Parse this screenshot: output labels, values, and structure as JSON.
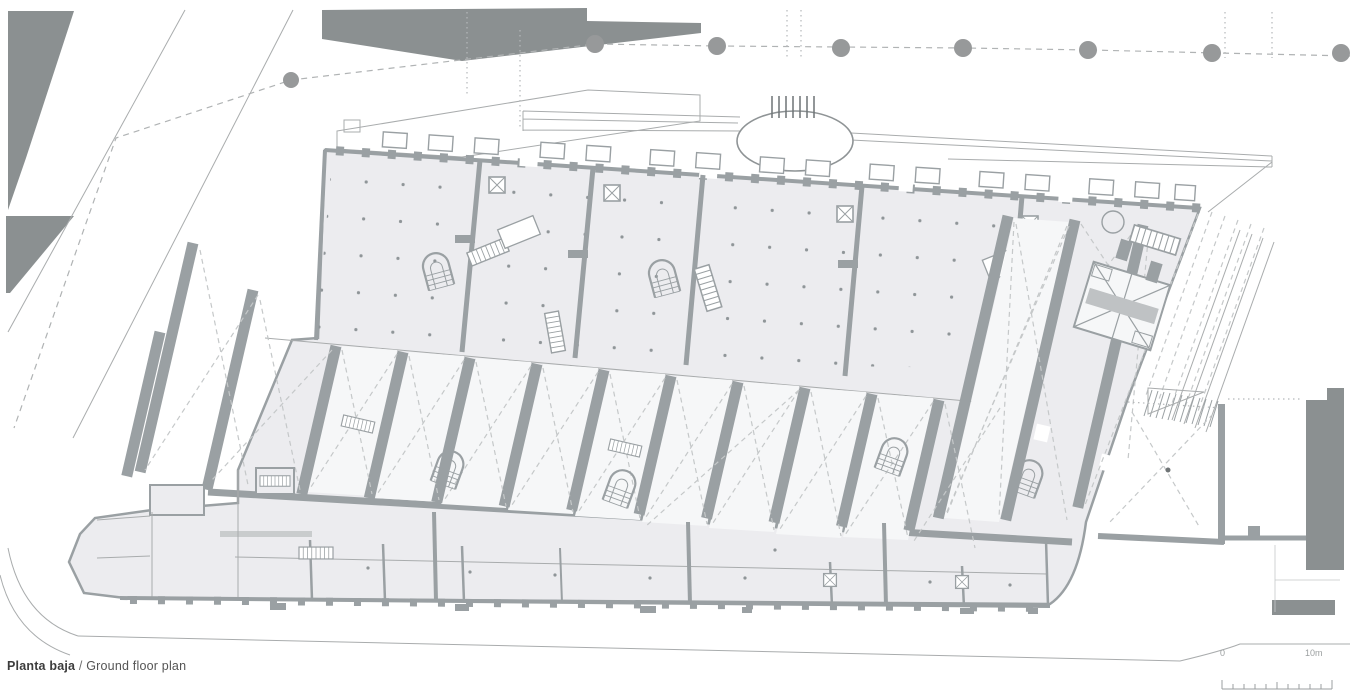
{
  "caption": {
    "label_es": "Planta baja",
    "separator": " / ",
    "label_en": "Ground floor plan"
  },
  "scale_bar": {
    "zero_label": "0",
    "end_label": "10m",
    "divisions": 10
  },
  "palette": {
    "context-dark": "#8b9091",
    "wall": "#9aa0a3",
    "wall-light": "#bfc2c4",
    "floor-fill": "#ececef",
    "bay-fill": "#f6f7f8",
    "dash": "#c5c8c9",
    "line": "#a9acad",
    "dot": "#8f9598",
    "text-dark": "#3c3c3c",
    "text-light": "#9b9fa0",
    "paper": "#ffffff"
  }
}
